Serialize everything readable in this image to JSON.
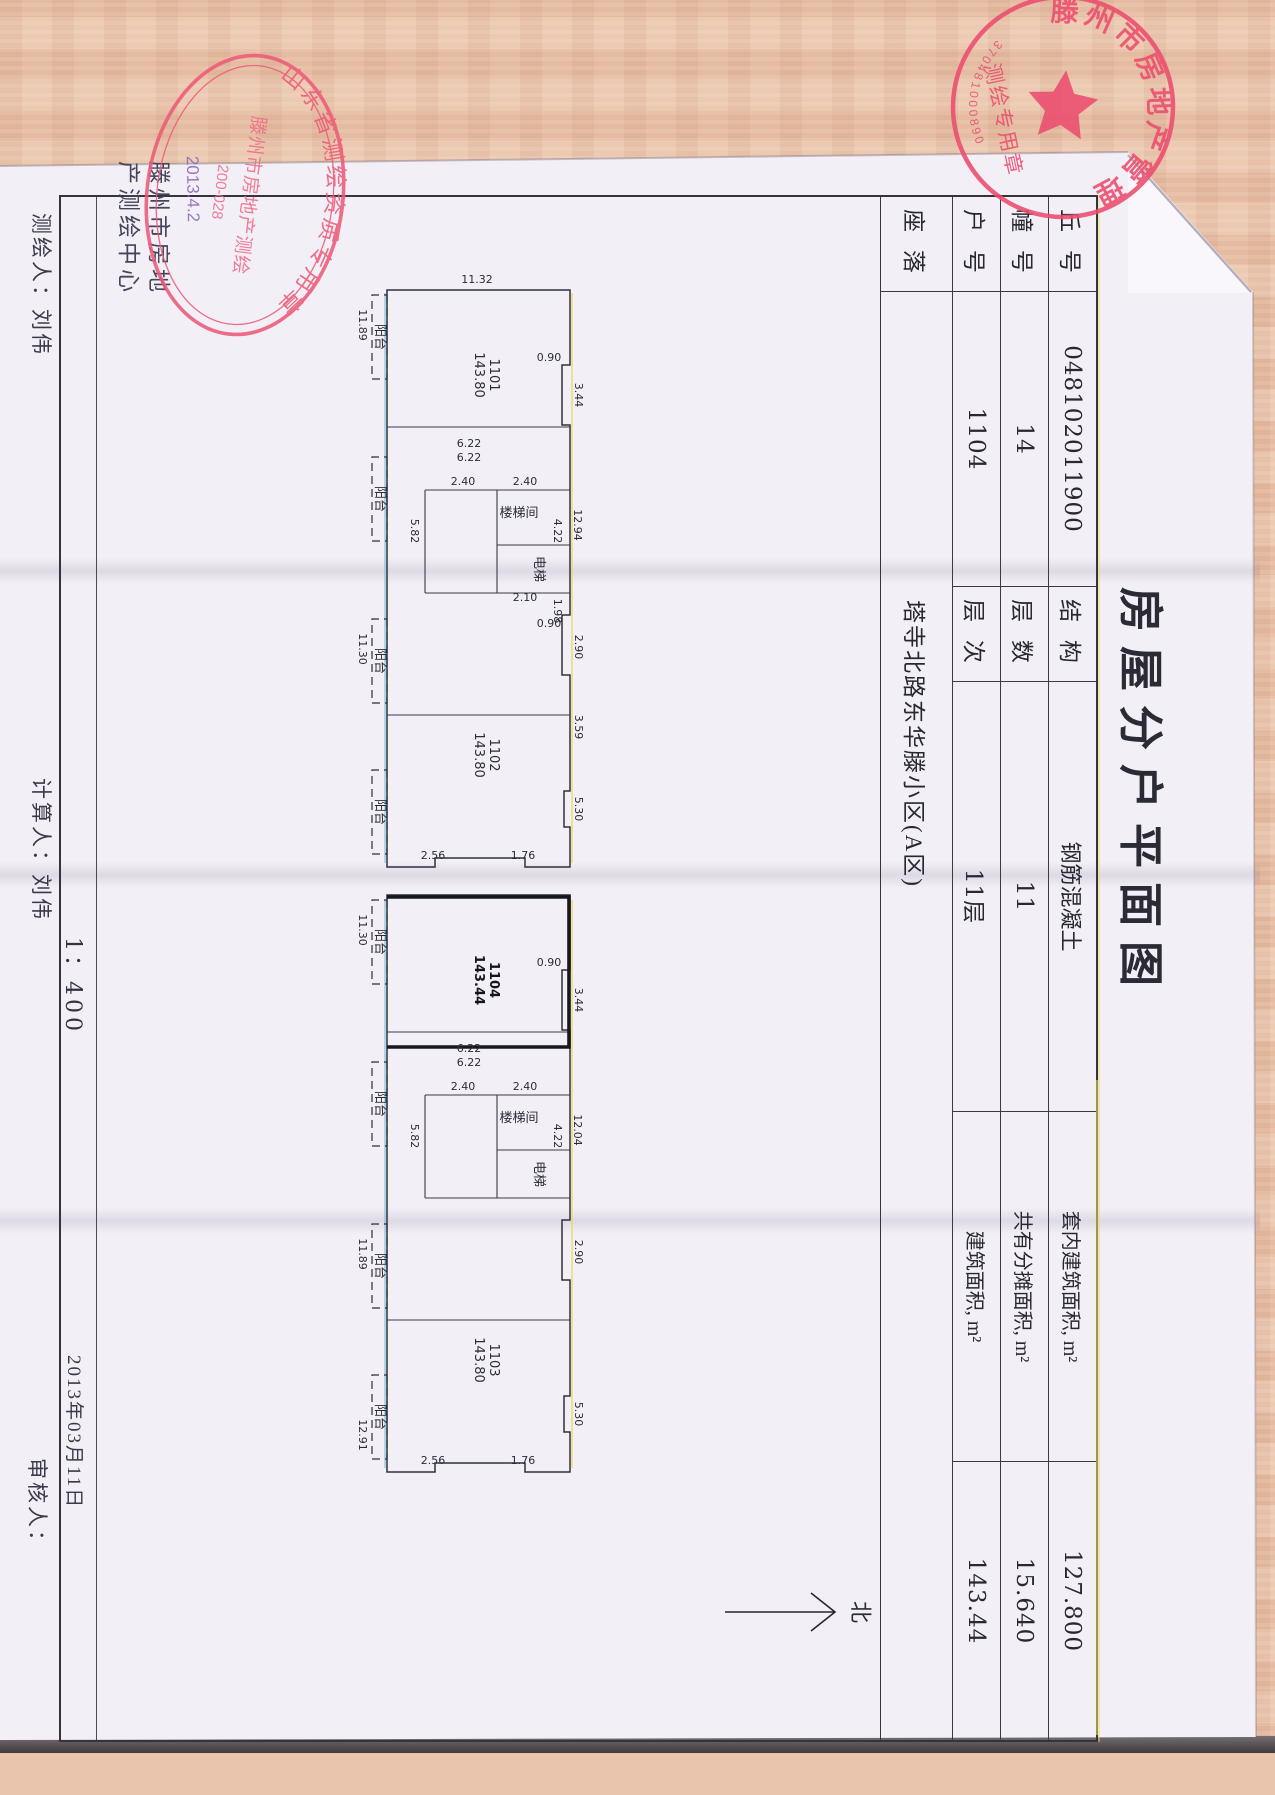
{
  "title": "房屋分户平面图",
  "info_table": {
    "rows": [
      {
        "c1": "丘 号",
        "v1": "048102011900",
        "c2": "结 构",
        "v2": "钢筋混凝土",
        "c3": "套内建筑面积, m²",
        "v3": "127.800"
      },
      {
        "c1": "幢 号",
        "v1": "14",
        "c2": "层 数",
        "v2": "11",
        "c3": "共有分摊面积, m²",
        "v3": "15.640"
      },
      {
        "c1": "户 号",
        "v1": "1104",
        "c2": "层 次",
        "v2": "11层",
        "c3": "建筑面积, m²",
        "v3": "143.44"
      },
      {
        "c1": "座 落",
        "v1": "塔寺北路东华滕小区(A区)"
      }
    ]
  },
  "plan": {
    "scale": "1：400",
    "north_label": "北",
    "rooms": [
      {
        "t": "1101",
        "t2": "143.80",
        "x": 180,
        "y": 735
      },
      {
        "t": "1102",
        "t2": "143.80",
        "x": 560,
        "y": 735
      },
      {
        "t": "楼梯间",
        "x": 322,
        "y": 706,
        "r": -90,
        "s": 10
      },
      {
        "t": "电梯",
        "x": 374,
        "y": 690,
        "s": 10
      },
      {
        "t": "1104",
        "t2": "143.44",
        "x": 785,
        "y": 735,
        "b": 1
      },
      {
        "t": "1103",
        "t2": "143.80",
        "x": 1165,
        "y": 735
      },
      {
        "t": "楼梯间",
        "x": 927,
        "y": 706,
        "r": -90,
        "s": 10
      },
      {
        "t": "电梯",
        "x": 979,
        "y": 690,
        "s": 10
      },
      {
        "t": "阳台",
        "x": 142,
        "y": 849,
        "s": 8
      },
      {
        "t": "阳台",
        "x": 304,
        "y": 849,
        "s": 8
      },
      {
        "t": "阳台",
        "x": 466,
        "y": 849,
        "s": 8
      },
      {
        "t": "阳台",
        "x": 617,
        "y": 849,
        "s": 8
      },
      {
        "t": "阳台",
        "x": 747,
        "y": 849,
        "s": 8
      },
      {
        "t": "阳台",
        "x": 909,
        "y": 849,
        "s": 8
      },
      {
        "t": "阳台",
        "x": 1071,
        "y": 849,
        "s": 8
      },
      {
        "t": "阳台",
        "x": 1222,
        "y": 849,
        "s": 8
      }
    ],
    "dimensions": [
      {
        "t": "12.94",
        "x": 330,
        "y": 651
      },
      {
        "t": "11.32",
        "x": 88,
        "y": 748,
        "r": -90
      },
      {
        "t": "0.90",
        "x": 166,
        "y": 676,
        "r": -90
      },
      {
        "t": "3.44",
        "x": 200,
        "y": 650
      },
      {
        "t": "0.90",
        "x": 432,
        "y": 676,
        "r": -90
      },
      {
        "t": "2.90",
        "x": 452,
        "y": 650
      },
      {
        "t": "3.59",
        "x": 532,
        "y": 650
      },
      {
        "t": "5.30",
        "x": 614,
        "y": 650
      },
      {
        "t": "11.89",
        "x": 130,
        "y": 866
      },
      {
        "t": "11.30",
        "x": 454,
        "y": 866
      },
      {
        "t": "6.22",
        "x": 252,
        "y": 756,
        "r": -90
      },
      {
        "t": "6.22",
        "x": 266,
        "y": 756,
        "r": -90
      },
      {
        "t": "4.22",
        "x": 336,
        "y": 671
      },
      {
        "t": "2.40",
        "x": 290,
        "y": 700,
        "r": -90
      },
      {
        "t": "2.40",
        "x": 290,
        "y": 762,
        "r": -90
      },
      {
        "t": "2.10",
        "x": 406,
        "y": 700,
        "r": -90
      },
      {
        "t": "5.82",
        "x": 336,
        "y": 814
      },
      {
        "t": "1.98",
        "x": 416,
        "y": 671
      },
      {
        "t": "1.76",
        "x": 664,
        "y": 702,
        "r": -90
      },
      {
        "t": "2.56",
        "x": 664,
        "y": 792,
        "r": -90
      },
      {
        "t": "12.04",
        "x": 935,
        "y": 651
      },
      {
        "t": "0.90",
        "x": 771,
        "y": 676,
        "r": -90
      },
      {
        "t": "3.44",
        "x": 805,
        "y": 650
      },
      {
        "t": "2.90",
        "x": 1057,
        "y": 650
      },
      {
        "t": "5.30",
        "x": 1219,
        "y": 650
      },
      {
        "t": "11.30",
        "x": 735,
        "y": 866
      },
      {
        "t": "11.89",
        "x": 1059,
        "y": 866
      },
      {
        "t": "4.22",
        "x": 941,
        "y": 671
      },
      {
        "t": "2.40",
        "x": 895,
        "y": 700,
        "r": -90
      },
      {
        "t": "2.40",
        "x": 895,
        "y": 762,
        "r": -90
      },
      {
        "t": "5.82",
        "x": 941,
        "y": 814
      },
      {
        "t": "6.22",
        "x": 857,
        "y": 756,
        "r": -90
      },
      {
        "t": "6.22",
        "x": 871,
        "y": 756,
        "r": -90
      },
      {
        "t": "1.76",
        "x": 1269,
        "y": 702,
        "r": -90
      },
      {
        "t": "2.56",
        "x": 1269,
        "y": 792,
        "r": -90
      },
      {
        "t": "12.91",
        "x": 1240,
        "y": 866
      }
    ]
  },
  "footer": {
    "mapper": "测绘人：刘伟",
    "calculator": "计算人：刘伟",
    "reviewer": "审核人：",
    "date": "2013年03月11日"
  },
  "org_block": {
    "line1": "滕州市房地",
    "line2": "产测绘中心"
  },
  "stamps": {
    "oval": {
      "rim": "山东省测绘资质专用章",
      "line1": "滕州市房地产测绘",
      "line2": "200-028",
      "note": "2013.4.2"
    },
    "round": {
      "rim": "滕州市房地产管理局",
      "banner": "测绘专用章",
      "code": "370481000890"
    }
  }
}
